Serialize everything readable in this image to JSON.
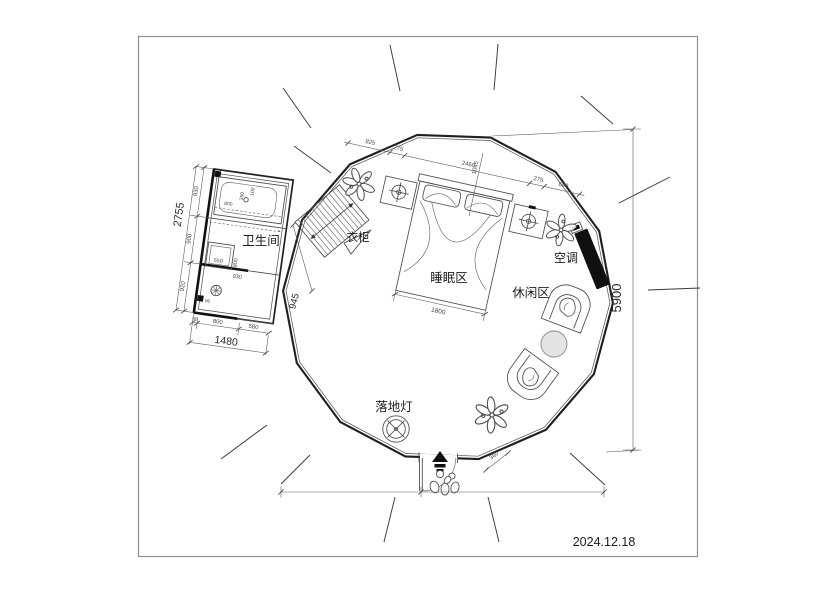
{
  "frame": {
    "date": "2024.12.18"
  },
  "labels": {
    "bathroom": "卫生间",
    "wardrobe": "衣柜",
    "sleeping_area": "睡眠区",
    "leisure_area": "休闲区",
    "air_conditioner": "空调",
    "floor_lamp": "落地灯"
  },
  "dimensions": {
    "overall_height": "5900",
    "bed_width": "1800",
    "entry_width": "360",
    "top_chain": [
      "825",
      "275",
      "2460",
      "1045"
    ],
    "top_right_chain": [
      "275",
      "690"
    ],
    "bath_left_chain": [
      "930",
      "900",
      "920"
    ],
    "bath_left_total": "2755",
    "bath_bottom_chain": [
      "90",
      "800",
      "580"
    ],
    "bath_bottom_total": "1480",
    "bath_diagonal": "945",
    "bath_inner": [
      "800",
      "350",
      "100",
      "550",
      "900",
      "930",
      "90"
    ]
  },
  "colors": {
    "line": "#1f1f1f",
    "dim": "#5f5f5f",
    "solid_fill": "#101010",
    "table_fill": "#e4e4e4"
  }
}
